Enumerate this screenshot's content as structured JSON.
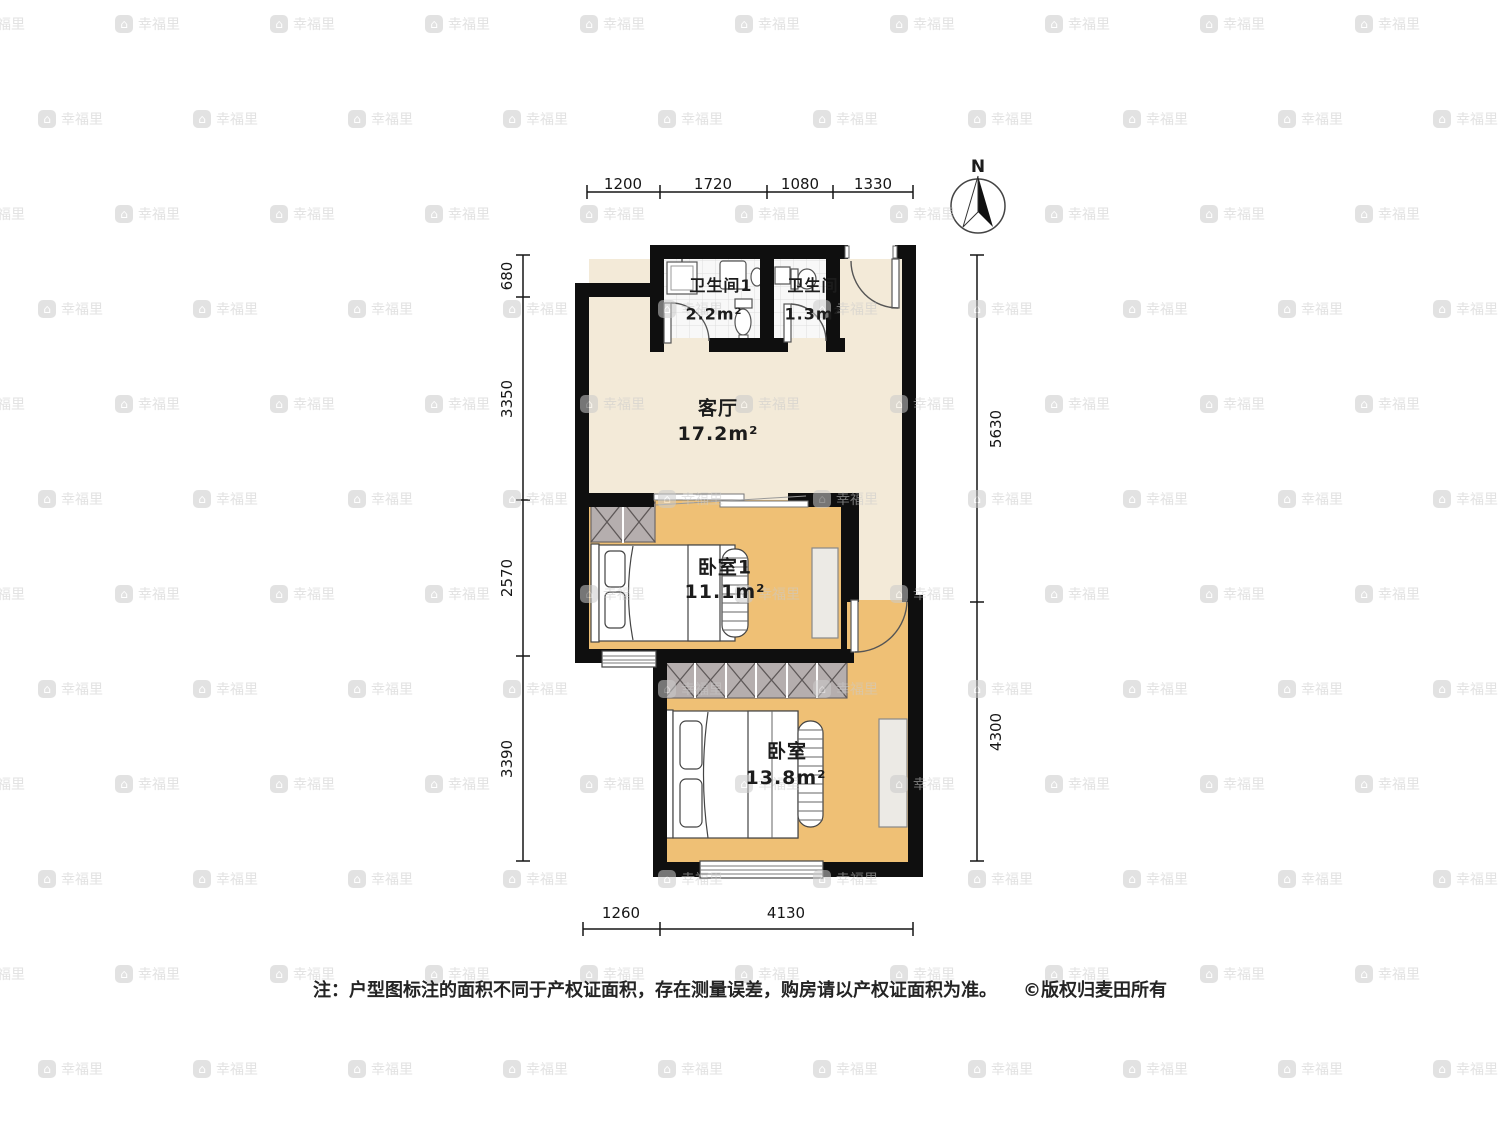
{
  "plan": {
    "compass": {
      "label": "N"
    },
    "rooms": [
      {
        "name": "客厅",
        "area": "17.2m²"
      },
      {
        "name": "卧室1",
        "area": "11.1m²"
      },
      {
        "name": "卧室",
        "area": "13.8m²"
      },
      {
        "name": "卫生间1",
        "area": "2.2m²"
      },
      {
        "name": "卫生间",
        "area": "1.3m²"
      }
    ],
    "dimensions": {
      "top": [
        "1200",
        "1720",
        "1080",
        "1330"
      ],
      "left": [
        "680",
        "3350",
        "2570",
        "3390"
      ],
      "right": [
        "5630",
        "4300"
      ],
      "bottom": [
        "1260",
        "4130"
      ]
    }
  },
  "footer": {
    "note": "注：户型图标注的面积不同于产权证面积，存在测量误差，购房请以产权证面积为准。",
    "copyright": "©版权归麦田所有"
  },
  "watermark": {
    "text": "幸福里",
    "icon": "⌂"
  },
  "colors": {
    "wall": "#0f0f0f",
    "floor_living": "#f3ead8",
    "floor_bedroom": "#efc075",
    "floor_bath": "#f8f8f8",
    "wardrobe": "#b5aeae",
    "cabinet": "#eceae5"
  }
}
